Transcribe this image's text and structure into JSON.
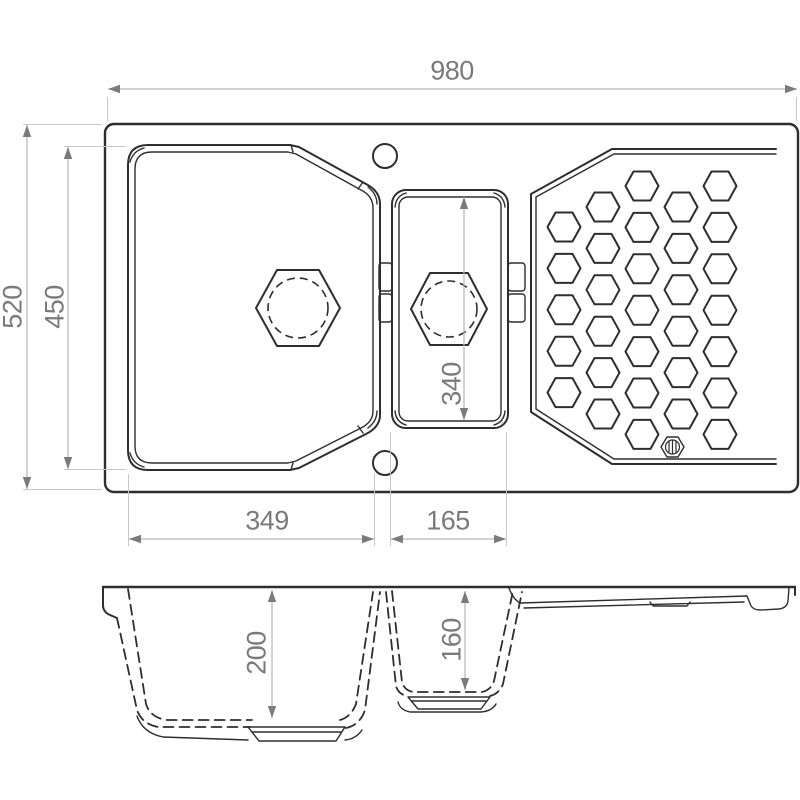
{
  "drawing": {
    "kind": "sink-dimension-drawing",
    "views": {
      "top": "plan view",
      "bottom": "front section view"
    }
  },
  "dims": {
    "overall_width": "980",
    "overall_depth": "520",
    "main_bowl_plan_depth": "450",
    "main_bowl_plan_width": "349",
    "small_bowl_plan_width": "165",
    "small_bowl_plan_depth": "340",
    "main_bowl_depth": "200",
    "small_bowl_depth": "160"
  },
  "drainer": {
    "pattern": "honeycomb",
    "hole_count": 31,
    "emblem": "hexagon-circle-brand-mark"
  },
  "features": {
    "tap_holes": 2,
    "bowls": 2,
    "drains": 2
  },
  "colors": {
    "object_line": "#2e2e2e",
    "dimension_line": "#b8b8b8",
    "dimension_text": "#7a7a7a",
    "background": "#ffffff"
  }
}
